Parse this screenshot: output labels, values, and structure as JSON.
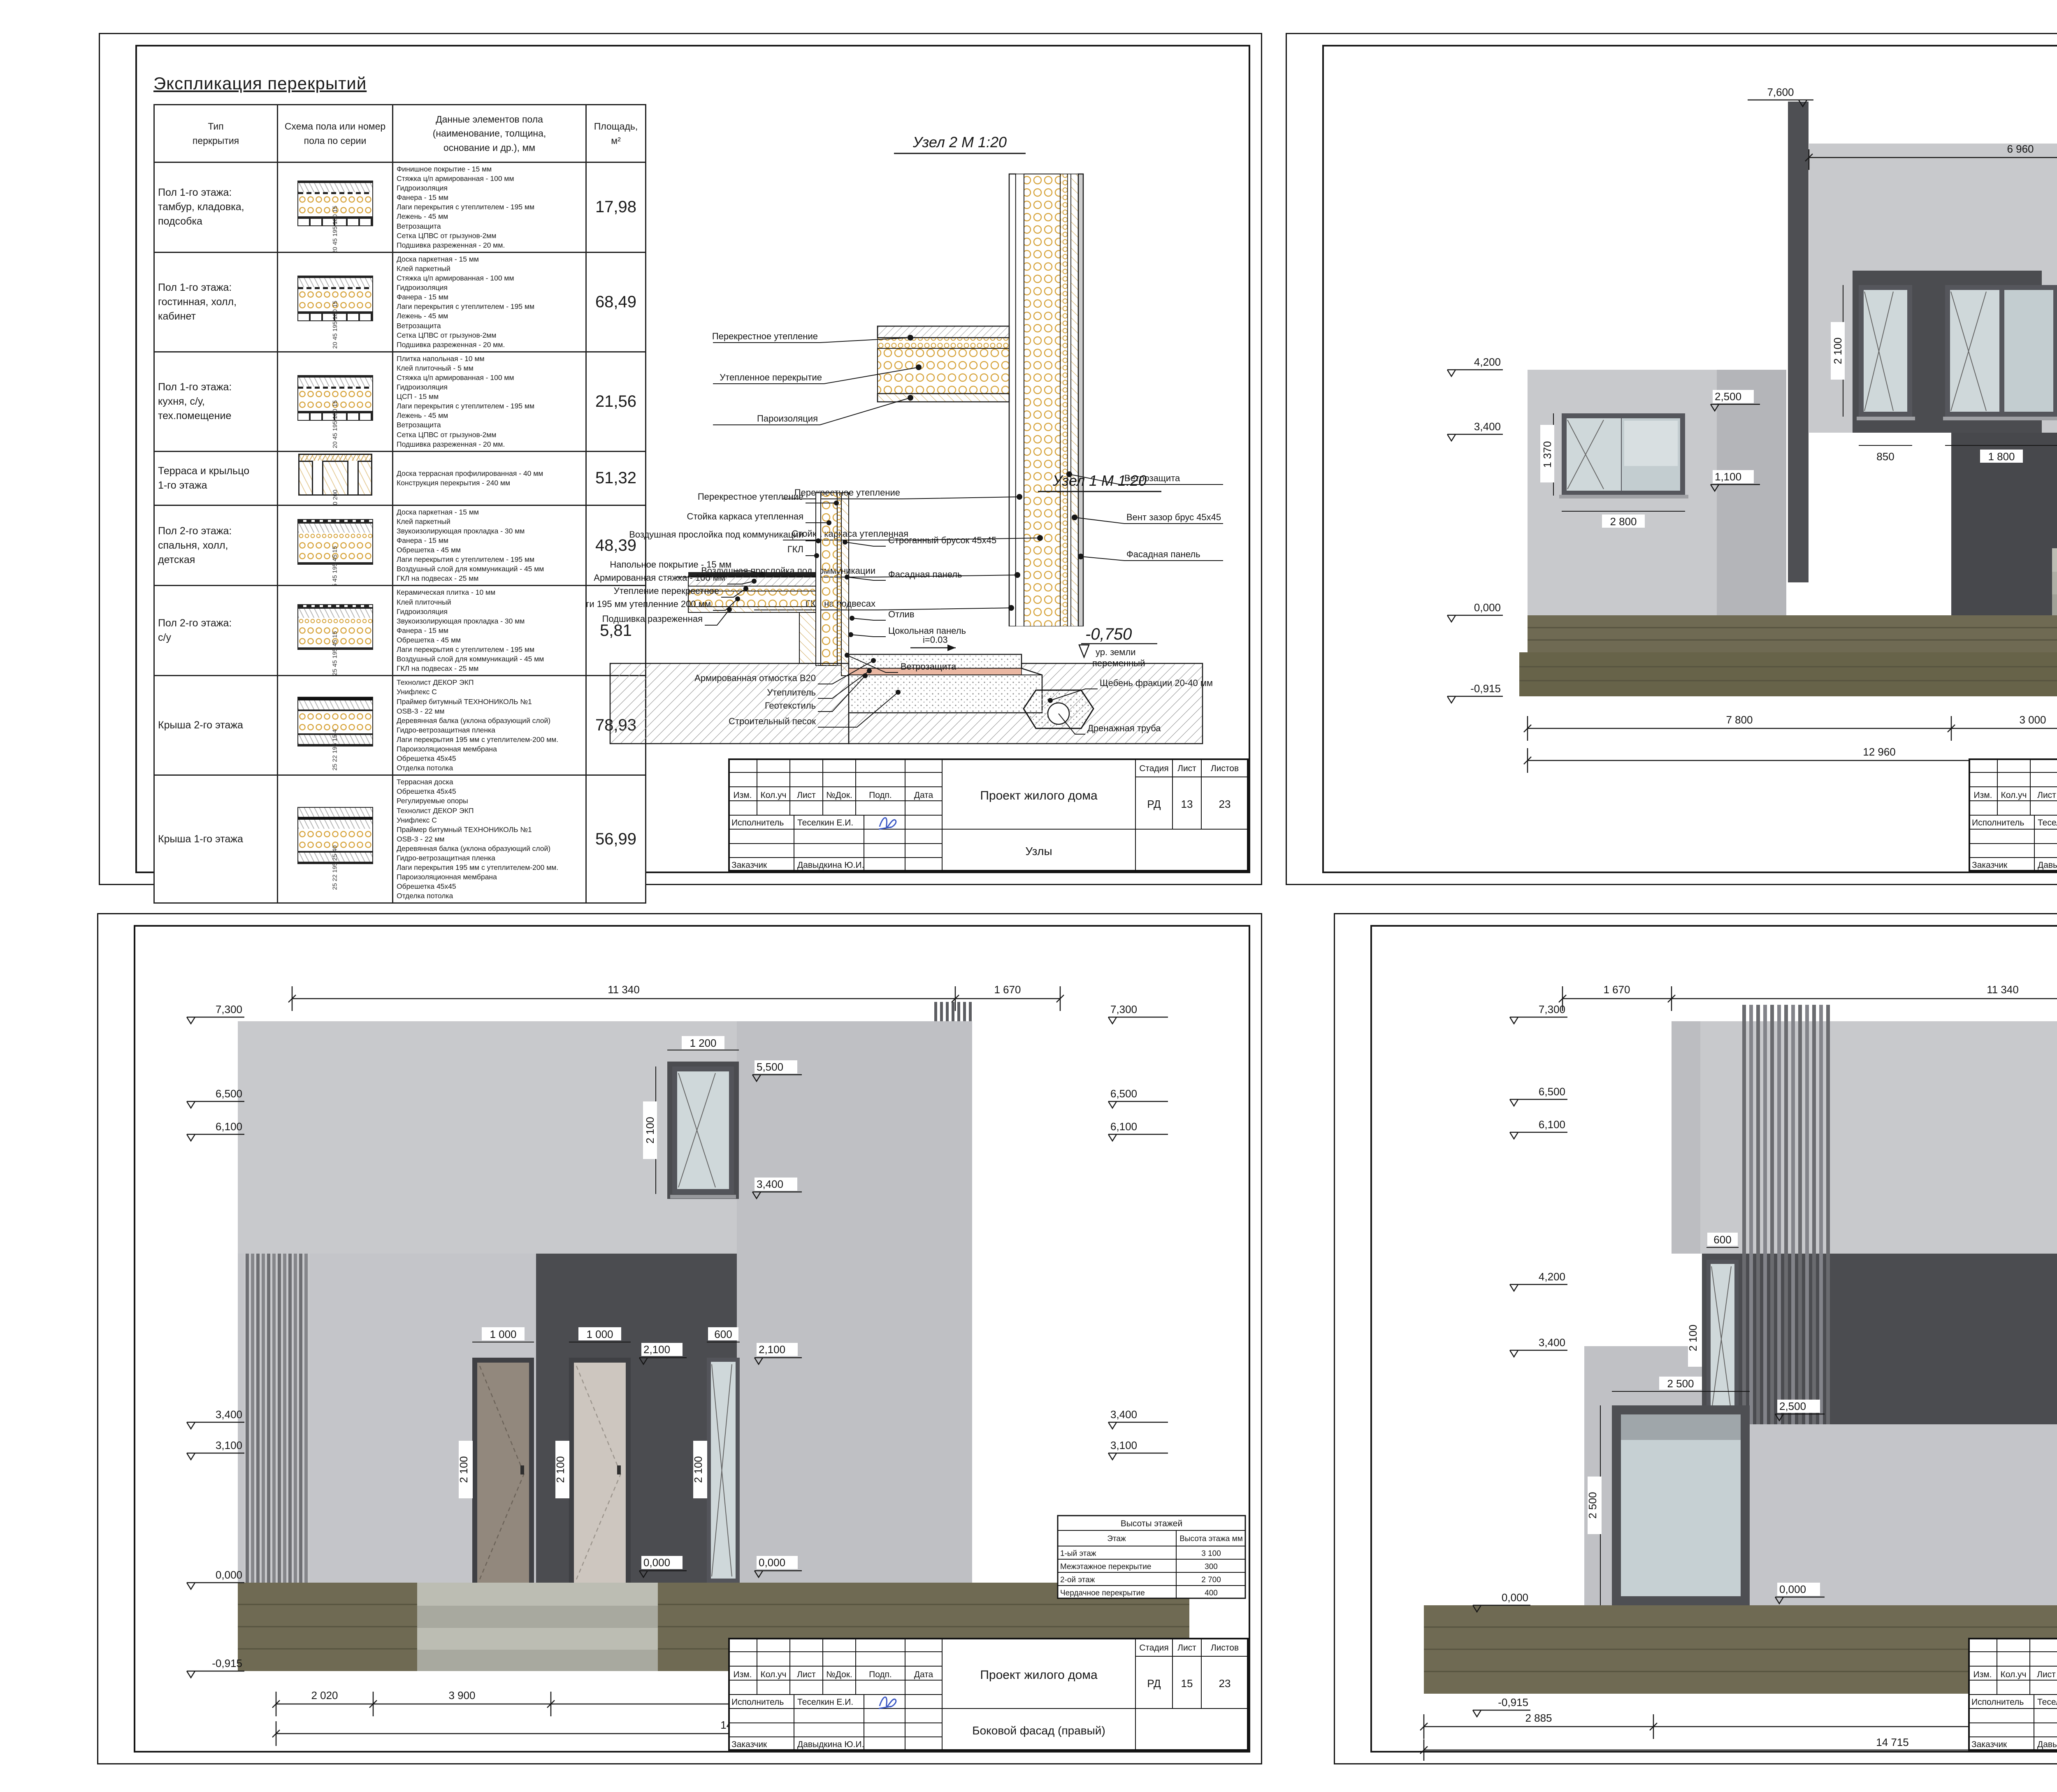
{
  "palette": {
    "paper": "#ffffff",
    "line": "#1a1a1a",
    "wall_light": "#c8c9cc",
    "wall_mid": "#b6b7bb",
    "panel_dark": "#4b4c50",
    "glass": "#cfd8da",
    "glass_dim": "#c3cdd0",
    "frame": "#53545a",
    "deck": "#6f6a53",
    "step": "#b9bab0",
    "door_a": "#92887d",
    "door_b": "#cdc6bf",
    "slat": "#6e6f73",
    "insulation": "#d7a43c",
    "signature": "#3a57c4"
  },
  "stamp": {
    "cols": [
      "Изм.",
      "Кол.уч",
      "Лист",
      "№Док.",
      "Подп.",
      "Дата"
    ],
    "executor_label": "Исполнитель",
    "executor": "Теселкин Е.И.",
    "customer_label": "Заказчик",
    "customer": "Давыдкина Ю.И.",
    "project": "Проект жилого дома",
    "stage_label": "Стадия",
    "sheet_label": "Лист",
    "sheets_label": "Листов",
    "stage": "РД",
    "total_sheets": "23"
  },
  "heights": {
    "title": "Высоты этажей",
    "col_floor": "Этаж",
    "col_height": "Высота этажа мм",
    "rows": [
      {
        "floor": "1-ый этаж",
        "h": "3 100"
      },
      {
        "floor": "Межэтажное перекрытие",
        "h": "300"
      },
      {
        "floor": "2-ой этаж",
        "h": "2 700"
      },
      {
        "floor": "Чердачное перекрытие",
        "h": "400"
      }
    ]
  },
  "s1": {
    "doc": "Узлы",
    "no": "13",
    "title": "Экспликация перекрытий",
    "headers": {
      "type": "Тип\nперкрытия",
      "scheme": "Схема пола или номер\nпола по серии",
      "data": "Данные элементов пола\n(наименование, толщина,\nоснование и др.), мм",
      "area": "Площадь,\nм²"
    },
    "rows": [
      {
        "name": "Пол 1-го этажа:\nтамбур, кладовка,\nподсобка",
        "stack": "20 45 195 180 15",
        "layers": "Финишное покрытие - 15 мм\nСтяжка ц/п армированная - 100 мм\nГидроизоляция\nФанера - 15 мм\nЛаги перекрытия с утеплителем - 195 мм\nЛежень - 45 мм\nВетрозащита\nСетка ЦПВС от грызунов-2мм\nПодшивка разреженная - 20 мм.",
        "area": "17,98"
      },
      {
        "name": "Пол 1-го этажа:\nгостинная, холл,\nкабинет",
        "stack": "20 45 195 180 15",
        "layers": "Доска паркетная - 15 мм\nКлей паркетный\nСтяжка ц/п армированная - 100 мм\nГидроизоляция\nФанера - 15 мм\nЛаги перекрытия с утеплителем - 195 мм\nЛежень - 45 мм\nВетрозащита\nСетка ЦПВС от грызунов-2мм\nПодшивка разреженная - 20 мм.",
        "area": "68,49"
      },
      {
        "name": "Пол 1-го этажа:\nкухня, с/у,\nтех.помещение",
        "stack": "20 45 195 180 15",
        "layers": "Плитка напольная - 10 мм\nКлей плиточный - 5 мм\nСтяжка ц/п армированная - 100 мм\nГидроизоляция\nЦСП - 15 мм\nЛаги перекрытия с утеплителем - 195 мм\nЛежень - 45 мм\nВетрозащита\nСетка ЦПВС от грызунов-2мм\nПодшивка разреженная - 20 мм.",
        "area": "21,56"
      },
      {
        "name": "Терраса и крыльцо\n1-го этажа",
        "stack": "40 200",
        "layers": "Доска террасная профилированная - 40 мм\nКонструкция перекрытия - 240 мм",
        "area": "51,32"
      },
      {
        "name": "Пол 2-го этажа:\nспальня, холл,\nдетская",
        "stack": "25 45 195 45 15",
        "layers": "Доска паркетная - 15 мм\nКлей паркетный\nЗвукоизолирующая прокладка - 30 мм\nФанера - 15 мм\nОбрешетка - 45 мм\nЛаги перекрытия с утеплителем - 195 мм\nВоздушный слой для коммуникаций - 45 мм\nГКЛ на подвесах - 25 мм",
        "area": "48,39"
      },
      {
        "name": "Пол 2-го этажа:\nс/у",
        "stack": "25 45 195 45 15",
        "layers": "Керамическая плитка - 10 мм\nКлей плиточный\nГидроизоляция\nЗвукоизолирующая прокладка - 30 мм\nФанера - 15 мм\nОбрешетка - 45 мм\nЛаги перекрытия с утеплителем - 195 мм\nВоздушный слой для коммуникаций - 45 мм\nГКЛ на подвесах - 25 мм",
        "area": "5,81"
      },
      {
        "name": "Крыша 2-го этажа",
        "stack": "25 22 195 15 4",
        "layers": "Технолист ДЕКОР ЭКП\nУнифлекс С\nПраймер битумный ТЕХНОНИКОЛЬ №1\nOSB-3  - 22 мм\nДеревянная балка (уклона образующий слой)\nГидро-ветрозащитная пленка\nЛаги перекрытия 195 мм с утеплителем-200 мм.\nПароизоляционная мембрана\nОбрешетка 45х45\nОтделка потолка",
        "area": "78,93"
      },
      {
        "name": "Крыша 1-го этажа",
        "stack": "25 22 195 25 40",
        "layers": "Террасная доска\nОбрешетка 45х45\nРегулируемые опоры\nТехнолист ДЕКОР ЭКП\nУнифлекс С\nПраймер битумный ТЕХНОНИКОЛЬ №1\nOSB-3  - 22 мм\nДеревянная балка (уклона образующий слой)\nГидро-ветрозащитная пленка\nЛаги перекрытия 195 мм с утеплителем-200 мм.\nПароизоляционная мембрана\nОбрешетка 45х45\nОтделка потолка",
        "area": "56,99"
      }
    ],
    "node2": {
      "title": "Узел 2 М 1:20",
      "left": [
        "Перекрестное утепление",
        "Утепленное перекрытие",
        "Пароизоляция",
        "Перекрестное утепление",
        "Стойка каркаса утепленная",
        "Воздушная прослойка под коммуникации",
        "ГКЛ на подвесах"
      ],
      "right": [
        "Ветрозащита",
        "Вент зазор брус 45х45",
        "Фасадная панель"
      ]
    },
    "node1": {
      "title": "Узел 1 М 1:20",
      "left": [
        "Перекрестное утепление",
        "Стойка каркаса утепленная",
        "Воздушная прослойка под коммуникации",
        "ГКЛ",
        "Напольное покрытие - 15 мм",
        "Армированная стяжка - 100 мм",
        "Утепление перекрестное",
        "Лаги 195 мм утепленние 200 мм",
        "Подшивка разреженная"
      ],
      "right": [
        "Строганный брусок 45х45",
        "Фасадная панель",
        "Отлив",
        "Цокольная панель",
        "Ветрозащита"
      ],
      "bottom": [
        "Армированная отмостка В20",
        "Утеплитель",
        "Геотекстиль",
        "Строительный песок"
      ],
      "slope": "i=0.03",
      "level": "-0,750",
      "note1": "ур. земли",
      "note2": "переменный",
      "gravel": "Щебень фракции 20-40 мм",
      "pipe": "Дренажная труба"
    }
  },
  "s2": {
    "doc": "Передний фасад",
    "no": "14",
    "dim": {
      "top": "6 960",
      "lvl76": "7,600",
      "w2h": "2 100",
      "w2a": "850",
      "w2b": "1 800",
      "lvl57": "5,700",
      "lvl36": "3,600",
      "ffh": "1 370",
      "ffw": "2 800",
      "lvl25": "2,500",
      "lvl11": "1,100",
      "L": [
        "4,200",
        "3,400",
        "0,000",
        "-0,915"
      ],
      "R": [
        "7,300",
        "6,500",
        "6,100",
        "3,400",
        "3,100",
        "0,000",
        "-0,915"
      ],
      "B": [
        "7 800",
        "3 000",
        "1 160",
        "1 000"
      ],
      "total": "12 960"
    }
  },
  "s3": {
    "doc": "Боковой фасад (правый)",
    "no": "15",
    "dim": {
      "t1": "11 340",
      "t2": "1 670",
      "w": "1 200",
      "wh": "2 100",
      "lvl55": "5,500",
      "lvl34": "3,400",
      "d1": "1 000",
      "d2": "1 000",
      "d3": "600",
      "dh": "2 100",
      "lvl21": "2,100",
      "lvl0": "0,000",
      "L": [
        "7,300",
        "6,500",
        "6,100",
        "3,400",
        "3,100",
        "0,000",
        "-0,915"
      ],
      "R": [
        "7,300",
        "6,500",
        "6,100",
        "3,400",
        "3,100",
        "0,000",
        "-0,915"
      ],
      "B": [
        "2 020",
        "3 900",
        "5 910",
        "2 885"
      ],
      "total": "14 715"
    }
  },
  "s4": {
    "doc": "Боковой фасад (левый)",
    "no": "16",
    "dim": {
      "t1": "1 670",
      "t2": "11 340",
      "nw": "600",
      "nwh": "2 100",
      "sw": "850",
      "swh": "1 000",
      "lvl55": "5,500",
      "lvl45": "4,500",
      "gw": "2 500",
      "gh": "2 500",
      "lvl25": "2,500",
      "lvl0": "0,000",
      "L": [
        "7,300",
        "6,500",
        "6,100",
        "4,200",
        "3,400",
        "0,000",
        "-0,915"
      ],
      "R": [
        "7,300",
        "6,500",
        "6,100",
        "3,400",
        "3,100",
        "-0,915"
      ],
      "B": [
        "2 885",
        "10 960",
        "870"
      ],
      "total": "14 715"
    }
  }
}
